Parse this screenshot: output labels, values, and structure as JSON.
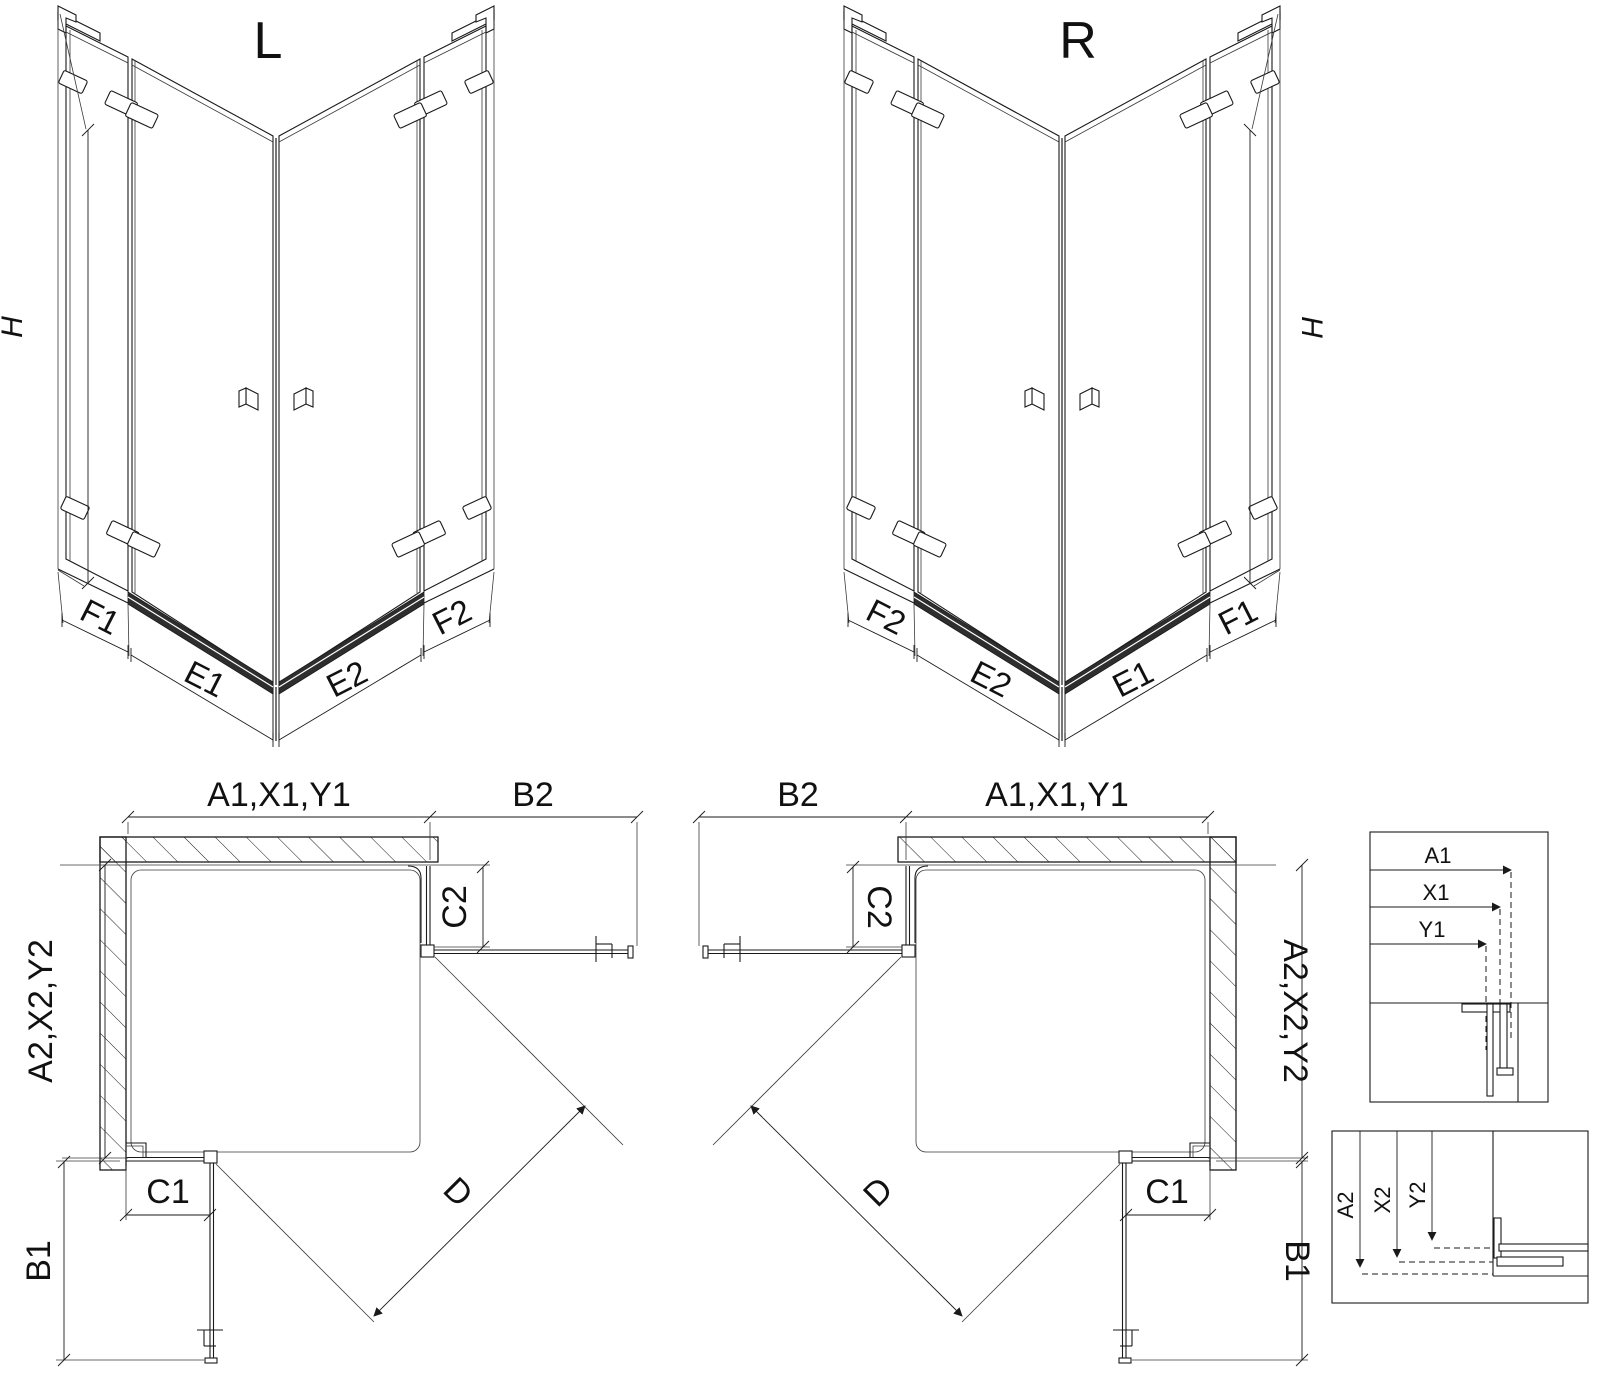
{
  "colors": {
    "line": "#1a1a1a",
    "background": "#ffffff"
  },
  "iso_left": {
    "title": "L",
    "height_label": "H",
    "bottom_labels": {
      "f1": "F1",
      "e1": "E1",
      "e2": "E2",
      "f2": "F2"
    }
  },
  "iso_right": {
    "title": "R",
    "height_label": "H",
    "bottom_labels": {
      "f2": "F2",
      "e2": "E2",
      "e1": "E1",
      "f1": "F1"
    }
  },
  "plan_left": {
    "top_dim": "A1,X1,Y1",
    "top_right_dim": "B2",
    "right_dim": "C2",
    "left_dim": "A2,X2,Y2",
    "bottom_left_dim": "B1",
    "bottom_dim": "C1",
    "diagonal_dim": "D"
  },
  "plan_right": {
    "top_left_dim": "B2",
    "top_dim": "A1,X1,Y1",
    "left_dim": "C2",
    "right_dim": "A2,X2,Y2",
    "bottom_right_dim": "B1",
    "bottom_dim": "C1",
    "diagonal_dim": "D"
  },
  "detail_top": {
    "dim1": "A1",
    "dim2": "X1",
    "dim3": "Y1"
  },
  "detail_bottom": {
    "dim1": "A2",
    "dim2": "X2",
    "dim3": "Y2"
  }
}
